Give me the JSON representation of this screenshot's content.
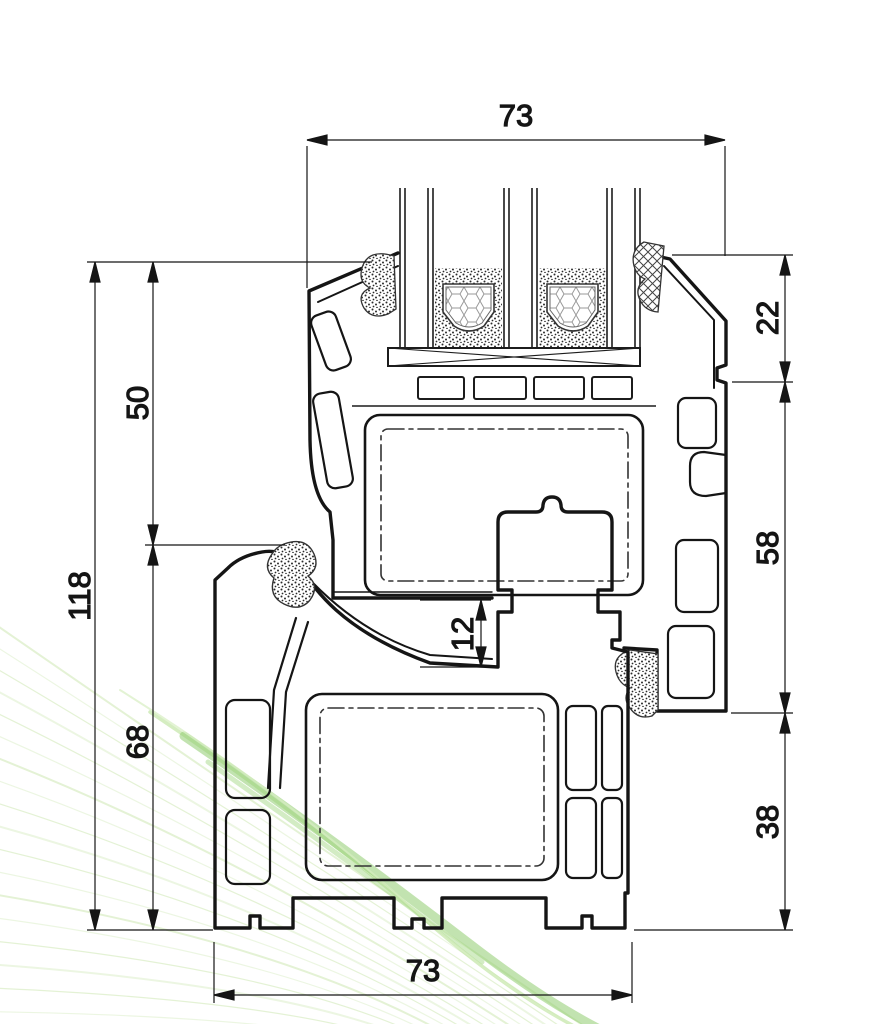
{
  "title": "PVC window frame and sash profile cross-section, technical drawing",
  "dims": {
    "top_width": "73",
    "bottom_width": "73",
    "total_height": "118",
    "sash_stack_height": "50",
    "frame_height": "68",
    "glazing_bead_height": "22",
    "sash_face_height": "58",
    "frame_face_height": "38",
    "rebate_gap": "12"
  },
  "colors": {
    "line": "#151515",
    "accent_green": "#8fcd6e",
    "background": "#ffffff"
  }
}
